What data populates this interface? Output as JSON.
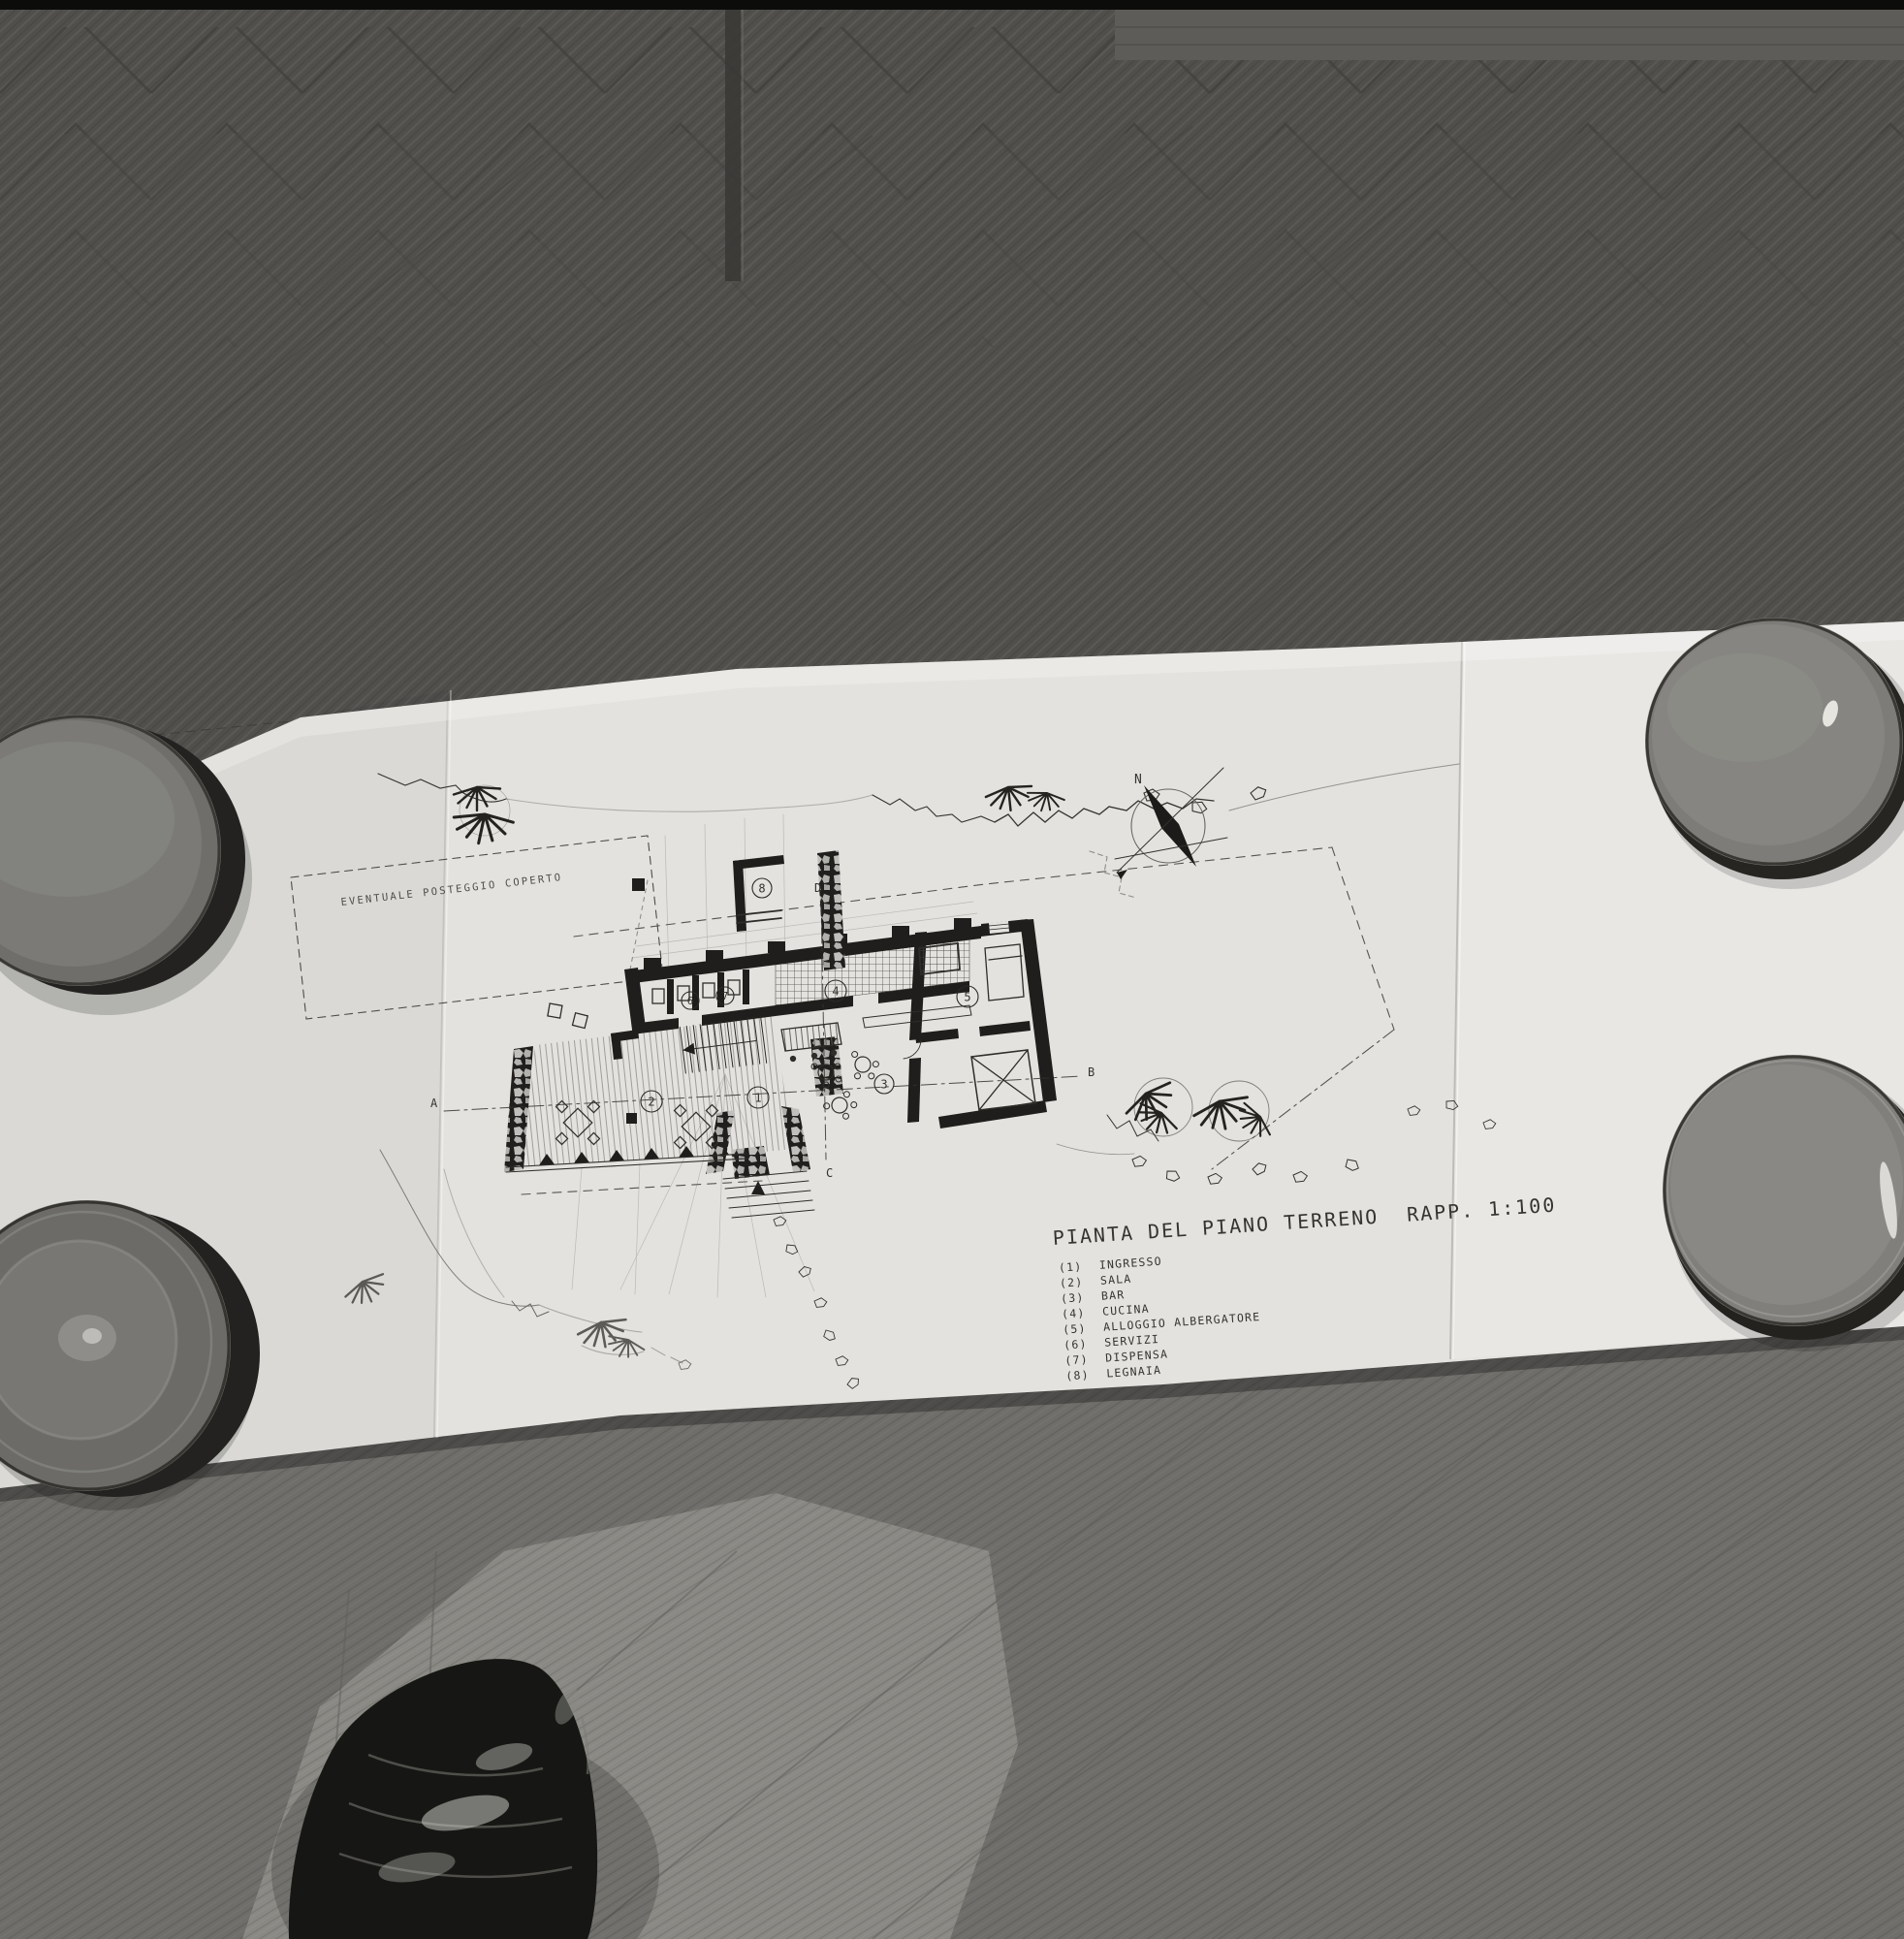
{
  "drawing": {
    "title": "PIANTA DEL PIANO TERRENO",
    "scale_label": "RAPP. 1:100",
    "annotation": "EVENTUALE POSTEGGIO COPERTO",
    "compass_north": "N",
    "legend": [
      {
        "num": "(1)",
        "label": "INGRESSO"
      },
      {
        "num": "(2)",
        "label": "SALA"
      },
      {
        "num": "(3)",
        "label": "BAR"
      },
      {
        "num": "(4)",
        "label": "CUCINA"
      },
      {
        "num": "(5)",
        "label": "ALLOGGIO ALBERGATORE"
      },
      {
        "num": "(6)",
        "label": "SERVIZI"
      },
      {
        "num": "(7)",
        "label": "DISPENSA"
      },
      {
        "num": "(8)",
        "label": "LEGNAIA"
      }
    ],
    "rooms": {
      "r1": "1",
      "r2": "2",
      "r3": "3",
      "r4": "4",
      "r5": "5",
      "r6": "6",
      "r7": "7",
      "r8": "8"
    },
    "sections": {
      "a": "A",
      "b": "B",
      "c": "C",
      "d": "D"
    }
  },
  "colors": {
    "paper": "#e3e2de",
    "ink": "#2b2a26",
    "floor_dark": "#504f4c",
    "floor_bottom": "#6f6e6a",
    "floor_light": "#8b8a85",
    "bowl": "#7d7c79",
    "shoe": "#161614"
  }
}
